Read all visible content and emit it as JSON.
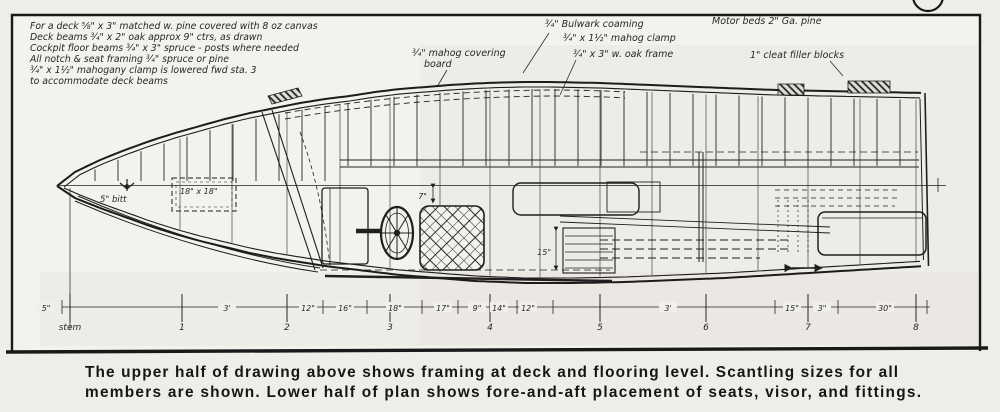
{
  "palette": {
    "paper": "#f1efe9",
    "paper_light": "#f4f2ec",
    "shade": "#e7e5df",
    "ink": "#1f1f1f",
    "ink_light": "#3a3a3a"
  },
  "notes_top_left": {
    "lines": [
      "For a deck ⅝\" x 3\" matched w. pine covered with 8 oz canvas",
      "Deck beams ¾\" x 2\" oak approx 9\" ctrs, as drawn",
      "Cockpit floor beams ¾\" x 3\" spruce - posts where needed",
      "All notch & seat framing ¾\" spruce or pine",
      "¾\" x 1½\" mahogany clamp is lowered fwd sta. 3",
      "to accommodate deck beams"
    ]
  },
  "callouts": {
    "covering_board_1": "¾\" mahog covering",
    "covering_board_2": "board",
    "bulwark_coaming": "¾\" Bulwark coaming",
    "mahog_clamp": "¾\" x 1½\" mahog clamp",
    "oak_frame": "¾\" x 3\" w. oak frame",
    "motor_beds": "Motor beds 2\" Ga. pine",
    "cleat_filler_blocks": "1\" cleat filler blocks",
    "bitt": "5\" bitt",
    "fwd_hatch": "18\" x 18\"",
    "seat_dim": "7\"",
    "engine_bed_dim": "15\""
  },
  "dimension_line": {
    "segment_labels": [
      {
        "x": 46,
        "text": "5\""
      },
      {
        "x": 227,
        "text": "3'"
      },
      {
        "x": 308,
        "text": "12\""
      },
      {
        "x": 345,
        "text": "16\""
      },
      {
        "x": 395,
        "text": "18\""
      },
      {
        "x": 443,
        "text": "17\""
      },
      {
        "x": 477,
        "text": "9\""
      },
      {
        "x": 499,
        "text": "14\""
      },
      {
        "x": 528,
        "text": "12\""
      },
      {
        "x": 668,
        "text": "3'"
      },
      {
        "x": 792,
        "text": "15\""
      },
      {
        "x": 822,
        "text": "3\""
      },
      {
        "x": 885,
        "text": "30\""
      }
    ],
    "tick_xs": [
      62,
      70,
      182,
      287,
      323,
      367,
      390,
      422,
      458,
      490,
      517,
      553,
      600,
      706,
      775,
      808,
      838,
      916,
      927
    ],
    "stations": [
      {
        "x": 70,
        "label": "stem"
      },
      {
        "x": 182,
        "label": "1"
      },
      {
        "x": 287,
        "label": "2"
      },
      {
        "x": 390,
        "label": "3"
      },
      {
        "x": 490,
        "label": "4"
      },
      {
        "x": 600,
        "label": "5"
      },
      {
        "x": 706,
        "label": "6"
      },
      {
        "x": 808,
        "label": "7"
      },
      {
        "x": 916,
        "label": "8"
      }
    ]
  },
  "caption": {
    "line1": "The upper half of drawing above shows framing at deck and flooring level. Scantling sizes for all",
    "line2": "members are shown. Lower half of plan shows fore-and-aft placement of seats, visor, and fittings."
  }
}
